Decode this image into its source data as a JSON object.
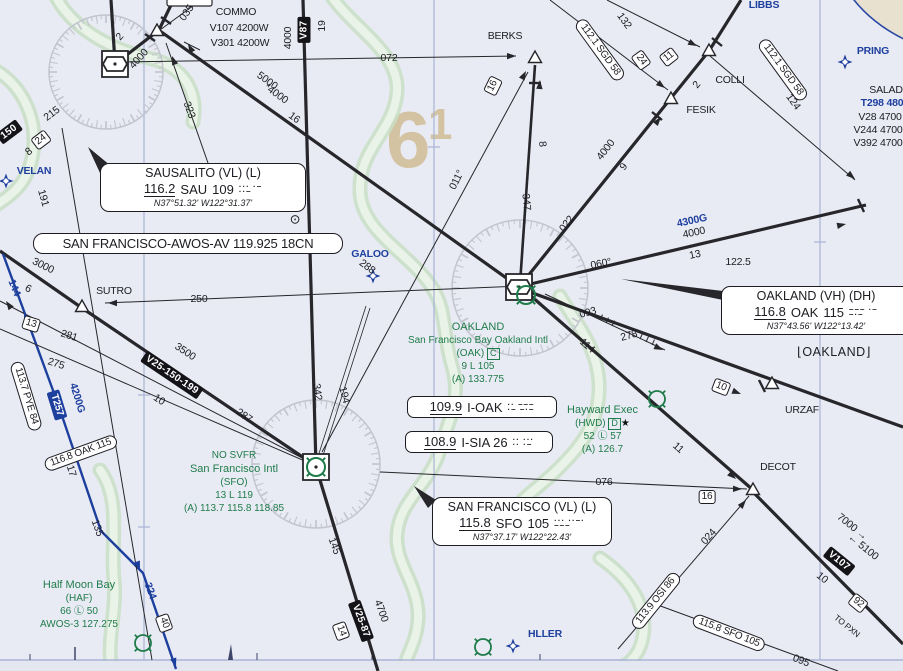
{
  "colors": {
    "aero_blue": "#1d3f9e",
    "airport_green": "#1f7c4a",
    "ink": "#1c1c22",
    "oroca_tan": "#d3c3a3",
    "water_green": "#cbe2c9",
    "land_tan": "#e9e1cf"
  },
  "navaids": {
    "sausalito": {
      "name": "SAUSALITO (VL) (L)",
      "freq": "116.2",
      "ident": "SAU",
      "channel": "109",
      "morse1": "··· ·–",
      "morse2": "··–",
      "coords": "N37°51.32' W122°31.37'"
    },
    "oakland": {
      "name": "OAKLAND (VH) (DH)",
      "freq": "116.8",
      "ident": "OAK",
      "channel": "115",
      "morse1": "––– ·–",
      "morse2": "–·–",
      "coords": "N37°43.56' W122°13.42'",
      "ctaf": "122.5"
    },
    "san_francisco": {
      "name": "SAN FRANCISCO (VL) (L)",
      "freq": "115.8",
      "ident": "SFO",
      "channel": "105",
      "morse1": "··· ··–·",
      "morse2": "–––",
      "coords": "N37°37.17' W122°22.43'"
    }
  },
  "awos": "SAN FRANCISCO-AWOS-AV 119.925 18CN",
  "localizers": {
    "ioak": {
      "freq": "109.9",
      "ident": "I-OAK",
      "morse1": "·· –––",
      "morse2": "·– –·–"
    },
    "isia": {
      "freq": "108.9",
      "ident": "I-SIA 26",
      "morse1": "·· ···",
      "morse2": "·· ·–"
    }
  },
  "airports": {
    "oakland_intl": {
      "name": "OAKLAND",
      "full": "San Francisco Bay Oakland Intl",
      "ident": "(OAK)",
      "class_letter": "C",
      "runway": "9 L 105",
      "atis": "(A) 133.775"
    },
    "hayward": {
      "name": "Hayward Exec",
      "ident": "(HWD)",
      "class_letter": "D",
      "star": "★",
      "elev": "52 Ⓛ 57",
      "atis": "(A) 126.7"
    },
    "san_francisco_intl": {
      "svfr": "NO SVFR",
      "name": "San Francisco Intl",
      "ident": "(SFO)",
      "runway": "13 L 119",
      "atis": "(A) 113.7 115.8 118.85"
    },
    "half_moon_bay": {
      "name": "Half Moon Bay",
      "ident": "(HAF)",
      "elev": "66 Ⓛ 50",
      "awos": "AWOS-3 127.275"
    }
  },
  "oroca": {
    "big": "6",
    "small": "1"
  },
  "labels": [
    {
      "t": "035",
      "x": 187,
      "y": 13,
      "r": -55
    },
    {
      "t": "COMMO",
      "x": 236,
      "y": 12
    },
    {
      "t": "V107 4200W",
      "x": 239,
      "y": 28
    },
    {
      "t": "V301 4200W",
      "x": 240,
      "y": 43
    },
    {
      "t": "072",
      "x": 389,
      "y": 58
    },
    {
      "t": "V87",
      "x": 304,
      "y": 30,
      "r": -90,
      "k": "a"
    },
    {
      "t": "4000",
      "x": 288,
      "y": 38,
      "r": -90
    },
    {
      "t": "19",
      "x": 322,
      "y": 26,
      "r": -90
    },
    {
      "t": "5000",
      "x": 267,
      "y": 81,
      "r": 36
    },
    {
      "t": "*4000",
      "x": 276,
      "y": 94,
      "r": 36
    },
    {
      "t": "16",
      "x": 294,
      "y": 118,
      "r": 36
    },
    {
      "t": "323",
      "x": 189,
      "y": 110,
      "r": 70
    },
    {
      "t": "2",
      "x": 120,
      "y": 37,
      "r": -48
    },
    {
      "t": "4000",
      "x": 139,
      "y": 59,
      "r": -48
    },
    {
      "t": "215",
      "x": 52,
      "y": 114,
      "r": -37
    },
    {
      "t": "24",
      "x": 41,
      "y": 140,
      "r": -37,
      "k": "b"
    },
    {
      "t": "8",
      "x": 29,
      "y": 152,
      "r": -37
    },
    {
      "t": "150",
      "x": 9,
      "y": 132,
      "r": -37,
      "k": "a"
    },
    {
      "t": "VELAN",
      "x": 34,
      "y": 171,
      "k": "bl"
    },
    {
      "t": "191",
      "x": 43,
      "y": 198,
      "r": 74
    },
    {
      "t": "3000",
      "x": 43,
      "y": 266,
      "r": 26
    },
    {
      "t": "6",
      "x": 28,
      "y": 289,
      "r": 26
    },
    {
      "t": "144",
      "x": 14,
      "y": 288,
      "r": 68,
      "k": "bl"
    },
    {
      "t": "SUTRO",
      "x": 114,
      "y": 291
    },
    {
      "t": "250",
      "x": 199,
      "y": 299
    },
    {
      "t": "281",
      "x": 69,
      "y": 336,
      "r": 17
    },
    {
      "t": "275",
      "x": 56,
      "y": 364,
      "r": 17
    },
    {
      "t": "13",
      "x": 31,
      "y": 324,
      "r": 17,
      "k": "b"
    },
    {
      "t": "113.7 PYE 84",
      "x": 26,
      "y": 396,
      "r": 73,
      "k": "f"
    },
    {
      "t": "T257",
      "x": 57,
      "y": 405,
      "r": 73,
      "k": "t"
    },
    {
      "t": "4200G",
      "x": 77,
      "y": 398,
      "r": 73,
      "k": "bl"
    },
    {
      "t": "116.8 OAK 115",
      "x": 81,
      "y": 453,
      "r": -20,
      "k": "f"
    },
    {
      "t": "17",
      "x": 71,
      "y": 471,
      "r": 73
    },
    {
      "t": "135",
      "x": 97,
      "y": 528,
      "r": 70
    },
    {
      "t": "324",
      "x": 150,
      "y": 591,
      "r": 70,
      "k": "bl"
    },
    {
      "t": "40",
      "x": 164,
      "y": 623,
      "r": 70,
      "k": "b"
    },
    {
      "t": "3500",
      "x": 185,
      "y": 352,
      "r": 34
    },
    {
      "t": "V25-150-199",
      "x": 172,
      "y": 375,
      "r": 34,
      "k": "a"
    },
    {
      "t": "10",
      "x": 159,
      "y": 400,
      "r": 34
    },
    {
      "t": "287",
      "x": 244,
      "y": 416,
      "r": 34
    },
    {
      "t": "342",
      "x": 317,
      "y": 392,
      "r": 82
    },
    {
      "t": "194",
      "x": 344,
      "y": 395,
      "r": 76
    },
    {
      "t": "GALOO",
      "x": 370,
      "y": 254,
      "k": "bl"
    },
    {
      "t": "288",
      "x": 367,
      "y": 267,
      "r": 37
    },
    {
      "t": "011°",
      "x": 457,
      "y": 180,
      "r": -64
    },
    {
      "t": "16",
      "x": 493,
      "y": 86,
      "r": -64,
      "k": "b"
    },
    {
      "t": "BERKS",
      "x": 505,
      "y": 36
    },
    {
      "t": "347",
      "x": 526,
      "y": 202,
      "r": 84
    },
    {
      "t": "8",
      "x": 542,
      "y": 144,
      "r": 84
    },
    {
      "t": "022",
      "x": 567,
      "y": 224,
      "r": -52
    },
    {
      "t": "4000",
      "x": 606,
      "y": 150,
      "r": -52
    },
    {
      "t": "9",
      "x": 624,
      "y": 167,
      "r": -52
    },
    {
      "t": "FESIK",
      "x": 701,
      "y": 110
    },
    {
      "t": "COLLI",
      "x": 730,
      "y": 80
    },
    {
      "t": "2",
      "x": 697,
      "y": 85,
      "r": -52
    },
    {
      "t": "112.1 SGD 58",
      "x": 600,
      "y": 50,
      "r": 54,
      "k": "f"
    },
    {
      "t": "132",
      "x": 624,
      "y": 21,
      "r": 54
    },
    {
      "t": "24",
      "x": 641,
      "y": 60,
      "r": 54,
      "k": "b"
    },
    {
      "t": "11",
      "x": 669,
      "y": 57,
      "r": -38,
      "k": "b"
    },
    {
      "t": "112.1 SGD 58",
      "x": 783,
      "y": 70,
      "r": 54,
      "k": "f"
    },
    {
      "t": "124",
      "x": 793,
      "y": 102,
      "r": 54
    },
    {
      "t": "LIBBS",
      "x": 764,
      "y": 5,
      "k": "bl"
    },
    {
      "t": "PRING",
      "x": 873,
      "y": 51,
      "k": "bl"
    },
    {
      "t": "SALAD",
      "x": 886,
      "y": 90
    },
    {
      "t": "T298 480",
      "x": 882,
      "y": 103,
      "k": "bl"
    },
    {
      "t": "V28 4700",
      "x": 880,
      "y": 117
    },
    {
      "t": "V244 4700",
      "x": 878,
      "y": 130
    },
    {
      "t": "V392 4700",
      "x": 878,
      "y": 143
    },
    {
      "t": "060°",
      "x": 601,
      "y": 264,
      "r": -11
    },
    {
      "t": "4300G",
      "x": 692,
      "y": 221,
      "r": -12,
      "k": "bl"
    },
    {
      "t": "4000",
      "x": 694,
      "y": 233,
      "r": -12
    },
    {
      "t": "13",
      "x": 695,
      "y": 255,
      "r": -12
    },
    {
      "t": "122.5",
      "x": 738,
      "y": 262
    },
    {
      "t": "093",
      "x": 588,
      "y": 313,
      "r": -15
    },
    {
      "t": "278",
      "x": 629,
      "y": 336,
      "r": -15
    },
    {
      "t": "114",
      "x": 587,
      "y": 346,
      "r": 41
    },
    {
      "t": "10",
      "x": 721,
      "y": 387,
      "r": 21,
      "k": "b"
    },
    {
      "t": "URZAF",
      "x": 802,
      "y": 410
    },
    {
      "t": "11",
      "x": 678,
      "y": 448,
      "r": 41
    },
    {
      "t": "DECOT",
      "x": 778,
      "y": 467
    },
    {
      "t": "076",
      "x": 604,
      "y": 482
    },
    {
      "t": "16",
      "x": 707,
      "y": 497,
      "k": "b"
    },
    {
      "t": "024",
      "x": 709,
      "y": 537,
      "r": -48
    },
    {
      "t": "113.9 OSI 86",
      "x": 656,
      "y": 601,
      "r": -51,
      "k": "f"
    },
    {
      "t": "115.8 SFO 105",
      "x": 729,
      "y": 633,
      "r": 21,
      "k": "f"
    },
    {
      "t": "095",
      "x": 801,
      "y": 661,
      "r": 21
    },
    {
      "t": "7000 →",
      "x": 852,
      "y": 527,
      "r": 39
    },
    {
      "t": "← 5100",
      "x": 863,
      "y": 547,
      "r": 39
    },
    {
      "t": "V107",
      "x": 839,
      "y": 561,
      "r": 39,
      "k": "a"
    },
    {
      "t": "10",
      "x": 822,
      "y": 578,
      "r": 39
    },
    {
      "t": "92",
      "x": 858,
      "y": 603,
      "r": 39,
      "k": "b"
    },
    {
      "t": "TO PXN",
      "x": 847,
      "y": 626,
      "r": 39,
      "k": "sm"
    },
    {
      "t": "145",
      "x": 334,
      "y": 546,
      "r": 70
    },
    {
      "t": "4700",
      "x": 381,
      "y": 611,
      "r": 70
    },
    {
      "t": "V25-87",
      "x": 361,
      "y": 621,
      "r": 70,
      "k": "a"
    },
    {
      "t": "14",
      "x": 341,
      "y": 631,
      "r": 70,
      "k": "b"
    },
    {
      "t": "HLLER",
      "x": 545,
      "y": 634,
      "k": "bl"
    },
    {
      "t": "⌊OAKLAND⌋",
      "x": 834,
      "y": 352,
      "k": "city"
    },
    {
      "t": "⊙",
      "x": 295,
      "y": 219,
      "k": "sym"
    }
  ]
}
